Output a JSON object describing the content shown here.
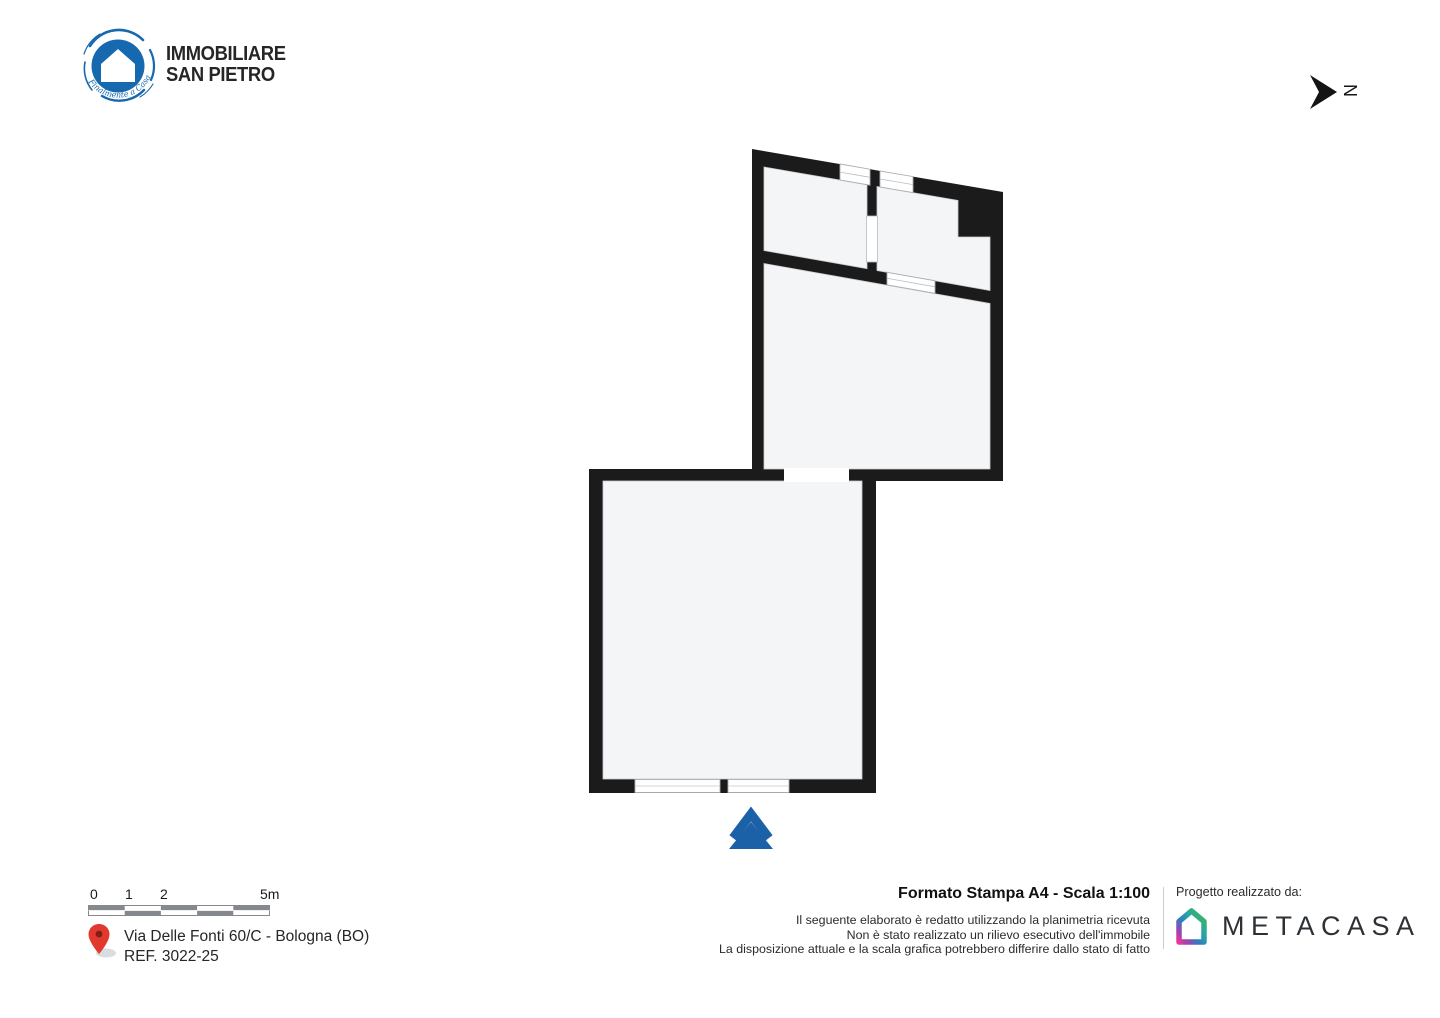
{
  "header": {
    "brand_line1": "IMMOBILIARE",
    "brand_line2": "SAN PIETRO",
    "brand_tagline": "Finalmente a Casa",
    "north_label": "N"
  },
  "colors": {
    "brand_blue": "#1669ae",
    "wall_black": "#1b1b1b",
    "room_fill": "#f4f5f6",
    "entrance_blue": "#1b61a8",
    "pin_red": "#e2392e"
  },
  "footer": {
    "scalebar_labels": [
      "0",
      "1",
      "2",
      "5m"
    ],
    "address_line1": "Via Delle Fonti 60/C - Bologna (BO)",
    "address_line2": "REF. 3022-25",
    "print_title": "Formato Stampa A4 - Scala 1:100",
    "disclaimer_line1": "Il seguente elaborato è redatto utilizzando la planimetria ricevuta",
    "disclaimer_line2": "Non è stato realizzato un rilievo esecutivo dell'immobile",
    "disclaimer_line3": "La disposizione attuale e la scala grafica potrebbero differire dallo stato di fatto",
    "credit_label": "Progetto realizzato da:",
    "credit_brand": "METACASA"
  }
}
